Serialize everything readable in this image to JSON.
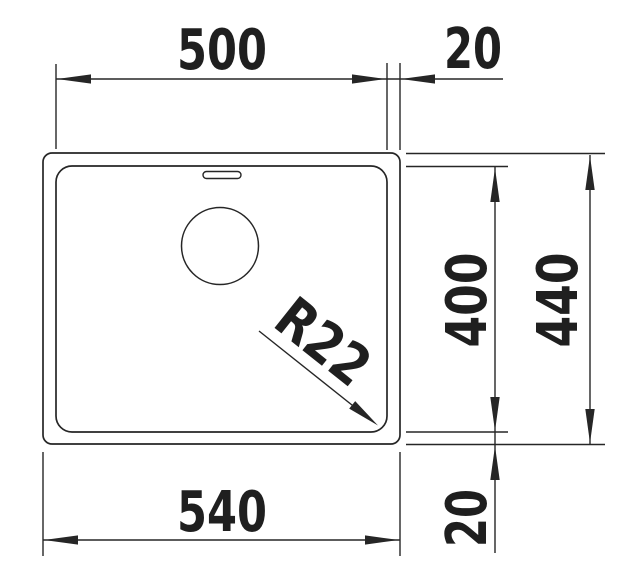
{
  "drawing": {
    "description": "Technical dimension drawing of a rectangular undermount sink bowl, top view, with drain hole, overflow slot and dimension lines",
    "units": "mm",
    "colors": {
      "line": "#262626",
      "text": "#1f1f1f",
      "background": "#ffffff"
    },
    "labels": {
      "inner_width": "500",
      "flange_right": "20",
      "inner_depth": "400",
      "outer_depth": "440",
      "outer_width": "540",
      "flange_bottom": "20",
      "corner_radius": "R22"
    }
  }
}
